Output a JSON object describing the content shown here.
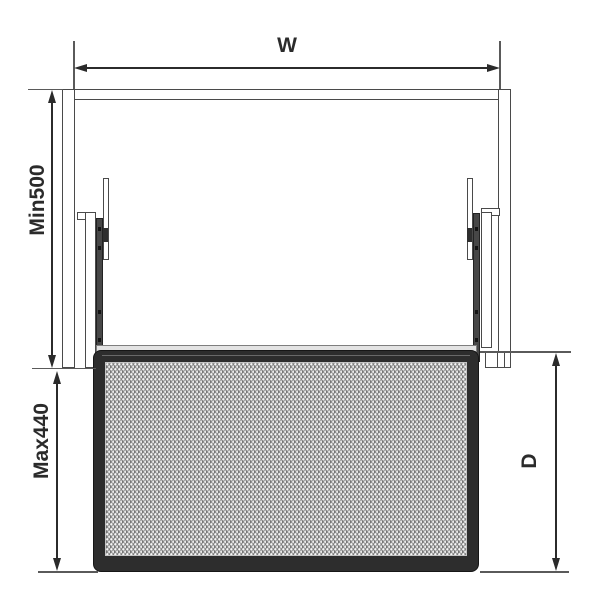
{
  "diagram": {
    "labels": {
      "width": "W",
      "min_cabinet_height": "Min500",
      "max_basket_height": "Max440",
      "depth": "D"
    },
    "colors": {
      "outline": "#4a4a4a",
      "dimension": "#2b2b2b",
      "basket_frame": "#2d2d2d",
      "basket_mesh": "#919191",
      "background": "#ffffff"
    }
  }
}
